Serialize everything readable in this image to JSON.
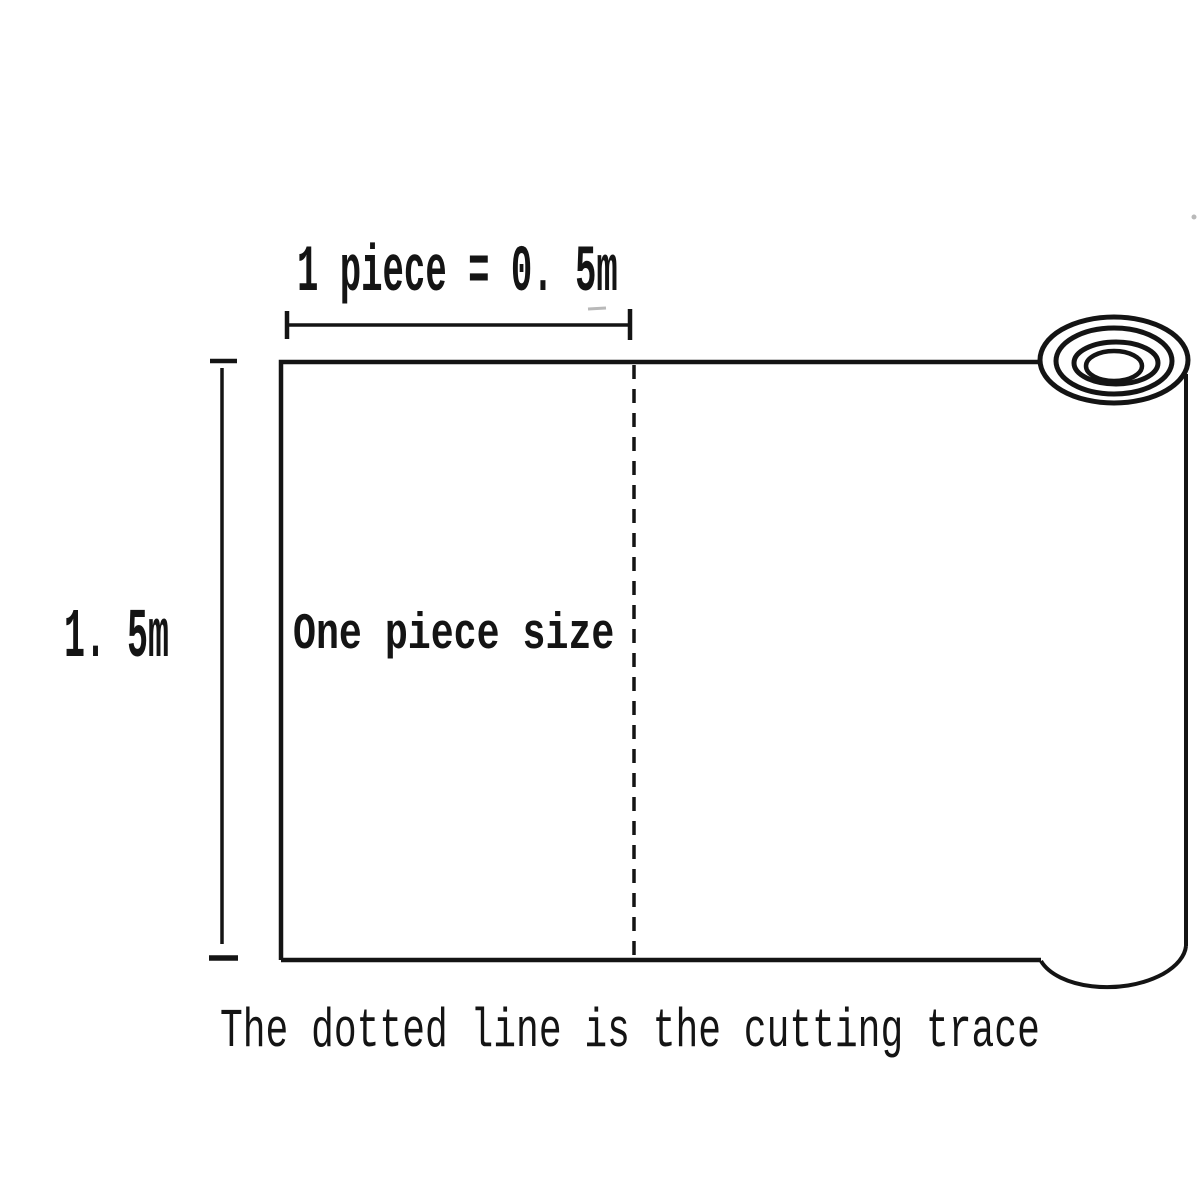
{
  "theme": {
    "background": "#ffffff",
    "ink": "#141414",
    "faint": "#b9b9b9"
  },
  "diagram": {
    "top_dimension_label": "1 piece = 0. 5m",
    "left_dimension_label": "1. 5m",
    "piece_label": "One piece size",
    "caption": "The dotted line is the cutting trace"
  }
}
